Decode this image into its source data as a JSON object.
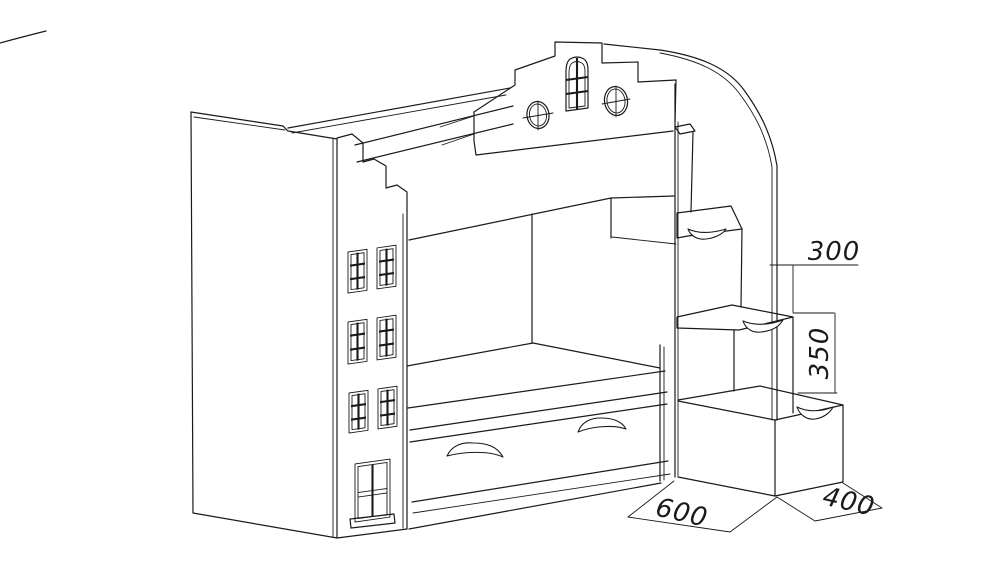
{
  "canvas": {
    "background": "#ffffff",
    "line_color": "#1a1a1a"
  },
  "dimensions": {
    "step_depth": "300",
    "step_height": "350",
    "stair_depth": "600",
    "stair_width": "400"
  }
}
